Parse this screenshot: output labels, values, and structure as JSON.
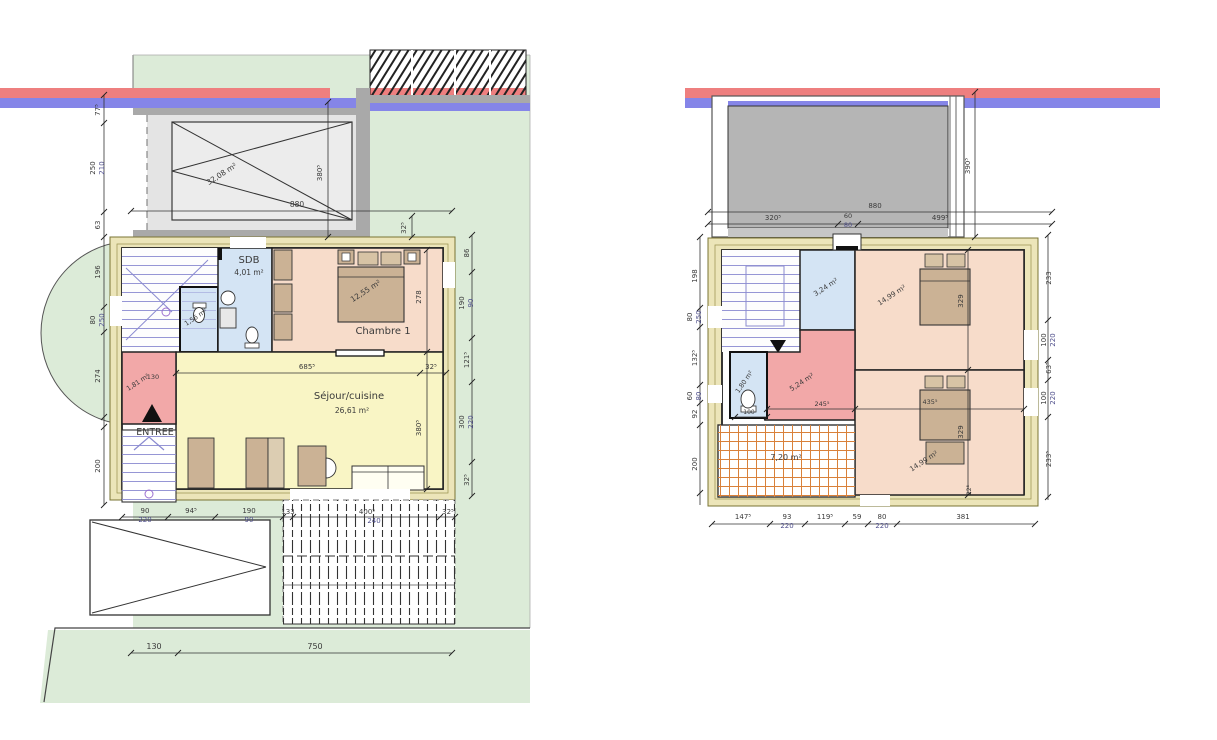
{
  "document": {
    "kind": "architectural floor plan, two levels side by side"
  },
  "colors": {
    "green": "#dcebd8",
    "red_stripe": "#ee7f7f",
    "blue_stripe": "#8585e8",
    "cream": "#ece5b9",
    "room_pink": "#f7dcca",
    "room_yellow": "#f9f5c5",
    "room_blue": "#d4e4f4",
    "room_red": "#f2a8a8",
    "roof_gray": "#b5b5b5",
    "drive_gray": "#e4e4e4",
    "wall_gray": "#a9a9a9",
    "furniture_tan": "#cbb295",
    "tile_orange": "#d9813a",
    "stair_blue": "#8a8ad0",
    "dim_color": "#3a3a3a",
    "dim_alt": "#50508c"
  },
  "ground_floor": {
    "rooms": [
      {
        "name": "SDB",
        "area": "4,01 m²"
      },
      {
        "name": "Chambre 1",
        "area": "12,55 m²"
      },
      {
        "name": "Séjour/cuisine",
        "area": "26,61 m²"
      },
      {
        "name": "WC",
        "area": "1,56 m²"
      },
      {
        "name": "Entrée",
        "area": "1,81 m²"
      }
    ],
    "entrance_label": "ENTREE",
    "carport_area": "32,08 m²"
  },
  "first_floor": {
    "rooms": [
      {
        "area": "3,24 m²"
      },
      {
        "area": "14,99 m²"
      },
      {
        "area": "5,24 m²"
      },
      {
        "area": "1,80 m²"
      },
      {
        "area": "7,20 m²"
      },
      {
        "area": "14,99 m²"
      }
    ]
  },
  "labels": [
    {
      "t": "SDB",
      "x": 249,
      "y": 263,
      "s": 10
    },
    {
      "t": "4,01 m²",
      "x": 249,
      "y": 275,
      "s": 7.5
    },
    {
      "t": "Chambre 1",
      "x": 383,
      "y": 334,
      "s": 10
    },
    {
      "t": "12,55 m²",
      "x": 367,
      "y": 293,
      "s": 7.5,
      "r": -33
    },
    {
      "t": "Séjour/cuisine",
      "x": 349,
      "y": 399,
      "s": 10
    },
    {
      "t": "26,61 m²",
      "x": 352,
      "y": 413,
      "s": 7.5
    },
    {
      "t": "ENTREE",
      "x": 155,
      "y": 435,
      "s": 9.5
    },
    {
      "t": "1,81 m²",
      "x": 139,
      "y": 384,
      "s": 6.5,
      "r": -33
    },
    {
      "t": "130",
      "x": 153,
      "y": 379,
      "s": 6.5
    },
    {
      "t": "1,56 m²",
      "x": 197,
      "y": 319,
      "s": 6.5,
      "r": -33
    },
    {
      "t": "32,08 m²",
      "x": 223,
      "y": 176,
      "s": 7.5,
      "r": -33
    },
    {
      "t": "880",
      "x": 297,
      "y": 207,
      "s": 7.5
    },
    {
      "t": "380⁵",
      "x": 322,
      "y": 173,
      "s": 7,
      "r": -90
    },
    {
      "t": "32⁵",
      "x": 406,
      "y": 228,
      "s": 7,
      "r": -90
    },
    {
      "t": "77⁵",
      "x": 100,
      "y": 110,
      "s": 7,
      "r": -90
    },
    {
      "t": "250",
      "x": 95,
      "y": 168,
      "s": 7,
      "r": -90
    },
    {
      "t": "210",
      "x": 104,
      "y": 168,
      "s": 7,
      "r": -90,
      "c": "#50508c"
    },
    {
      "t": "63",
      "x": 100,
      "y": 225,
      "s": 7,
      "r": -90
    },
    {
      "t": "196",
      "x": 100,
      "y": 272,
      "s": 7,
      "r": -90
    },
    {
      "t": "80",
      "x": 95,
      "y": 320,
      "s": 7,
      "r": -90
    },
    {
      "t": "250",
      "x": 104,
      "y": 320,
      "s": 7,
      "r": -90,
      "c": "#50508c"
    },
    {
      "t": "274",
      "x": 100,
      "y": 376,
      "s": 7,
      "r": -90
    },
    {
      "t": "200",
      "x": 100,
      "y": 466,
      "s": 7,
      "r": -90
    },
    {
      "t": "86",
      "x": 469,
      "y": 253,
      "s": 7,
      "r": -90
    },
    {
      "t": "190",
      "x": 464,
      "y": 303,
      "s": 7,
      "r": -90
    },
    {
      "t": "90",
      "x": 473,
      "y": 303,
      "s": 7,
      "r": -90,
      "c": "#50508c"
    },
    {
      "t": "121⁵",
      "x": 469,
      "y": 360,
      "s": 7,
      "r": -90
    },
    {
      "t": "300",
      "x": 464,
      "y": 422,
      "s": 7,
      "r": -90
    },
    {
      "t": "220",
      "x": 473,
      "y": 422,
      "s": 7,
      "r": -90,
      "c": "#50508c"
    },
    {
      "t": "32⁵",
      "x": 469,
      "y": 480,
      "s": 7,
      "r": -90
    },
    {
      "t": "685⁵",
      "x": 307,
      "y": 369,
      "s": 7
    },
    {
      "t": "32⁵",
      "x": 431,
      "y": 369,
      "s": 7
    },
    {
      "t": "278",
      "x": 421,
      "y": 297,
      "s": 7,
      "r": -90
    },
    {
      "t": "380⁵",
      "x": 421,
      "y": 428,
      "s": 7,
      "r": -90
    },
    {
      "t": "90",
      "x": 145,
      "y": 513,
      "s": 7
    },
    {
      "t": "220",
      "x": 145,
      "y": 522,
      "s": 7,
      "c": "#50508c"
    },
    {
      "t": "94⁵",
      "x": 191,
      "y": 513,
      "s": 7
    },
    {
      "t": "190",
      "x": 249,
      "y": 513,
      "s": 7
    },
    {
      "t": "90",
      "x": 249,
      "y": 522,
      "s": 7,
      "c": "#50508c"
    },
    {
      "t": "133",
      "x": 288,
      "y": 514,
      "s": 7
    },
    {
      "t": "400⁵",
      "x": 367,
      "y": 514,
      "s": 7
    },
    {
      "t": "240",
      "x": 374,
      "y": 523,
      "s": 7,
      "c": "#50508c"
    },
    {
      "t": "32⁵",
      "x": 448,
      "y": 514,
      "s": 7
    },
    {
      "t": "130",
      "x": 154,
      "y": 649,
      "s": 8
    },
    {
      "t": "750",
      "x": 315,
      "y": 649,
      "s": 8
    },
    {
      "t": "3,24 m²",
      "x": 827,
      "y": 289,
      "s": 7,
      "r": -33
    },
    {
      "t": "14,99 m²",
      "x": 893,
      "y": 297,
      "s": 7,
      "r": -33
    },
    {
      "t": "5,24 m²",
      "x": 803,
      "y": 384,
      "s": 7,
      "r": -33
    },
    {
      "t": "1,80 m²",
      "x": 746,
      "y": 383,
      "s": 6.5,
      "r": -55
    },
    {
      "t": "7,20 m²",
      "x": 786,
      "y": 460,
      "s": 8
    },
    {
      "t": "14,99 m²",
      "x": 925,
      "y": 463,
      "s": 7,
      "r": -33
    },
    {
      "t": "880",
      "x": 875,
      "y": 208,
      "s": 7
    },
    {
      "t": "320⁵",
      "x": 773,
      "y": 220,
      "s": 7
    },
    {
      "t": "60",
      "x": 848,
      "y": 218,
      "s": 6.5
    },
    {
      "t": "80",
      "x": 848,
      "y": 227,
      "s": 6.5,
      "c": "#50508c"
    },
    {
      "t": "499⁵",
      "x": 940,
      "y": 220,
      "s": 7
    },
    {
      "t": "390⁵",
      "x": 970,
      "y": 166,
      "s": 7,
      "r": -90
    },
    {
      "t": "198",
      "x": 697,
      "y": 276,
      "s": 7,
      "r": -90
    },
    {
      "t": "80",
      "x": 692,
      "y": 317,
      "s": 7,
      "r": -90
    },
    {
      "t": "250",
      "x": 701,
      "y": 317,
      "s": 7,
      "r": -90,
      "c": "#50508c"
    },
    {
      "t": "132⁵",
      "x": 697,
      "y": 358,
      "s": 7,
      "r": -90
    },
    {
      "t": "60",
      "x": 692,
      "y": 396,
      "s": 7,
      "r": -90
    },
    {
      "t": "80",
      "x": 701,
      "y": 396,
      "s": 7,
      "r": -90,
      "c": "#50508c"
    },
    {
      "t": "92",
      "x": 697,
      "y": 414,
      "s": 7,
      "r": -90
    },
    {
      "t": "200",
      "x": 697,
      "y": 464,
      "s": 7,
      "r": -90
    },
    {
      "t": "233",
      "x": 1051,
      "y": 278,
      "s": 7,
      "r": -90
    },
    {
      "t": "100",
      "x": 1046,
      "y": 340,
      "s": 7,
      "r": -90
    },
    {
      "t": "220",
      "x": 1055,
      "y": 340,
      "s": 7,
      "r": -90,
      "c": "#50508c"
    },
    {
      "t": "63⁵",
      "x": 1051,
      "y": 368,
      "s": 7,
      "r": -90
    },
    {
      "t": "100",
      "x": 1046,
      "y": 398,
      "s": 7,
      "r": -90
    },
    {
      "t": "220",
      "x": 1055,
      "y": 398,
      "s": 7,
      "r": -90,
      "c": "#50508c"
    },
    {
      "t": "233⁵",
      "x": 1051,
      "y": 459,
      "s": 7,
      "r": -90
    },
    {
      "t": "147⁵",
      "x": 743,
      "y": 519,
      "s": 7
    },
    {
      "t": "93",
      "x": 787,
      "y": 519,
      "s": 7
    },
    {
      "t": "220",
      "x": 787,
      "y": 528,
      "s": 7,
      "c": "#50508c"
    },
    {
      "t": "119⁵",
      "x": 825,
      "y": 519,
      "s": 7
    },
    {
      "t": "59",
      "x": 857,
      "y": 519,
      "s": 7
    },
    {
      "t": "80",
      "x": 882,
      "y": 519,
      "s": 7
    },
    {
      "t": "220",
      "x": 882,
      "y": 528,
      "s": 7,
      "c": "#50508c"
    },
    {
      "t": "381",
      "x": 963,
      "y": 519,
      "s": 7
    },
    {
      "t": "245⁵",
      "x": 822,
      "y": 406,
      "s": 6.5
    },
    {
      "t": "435⁵",
      "x": 930,
      "y": 404,
      "s": 6.5
    },
    {
      "t": "100",
      "x": 749,
      "y": 414,
      "s": 6
    },
    {
      "t": "329",
      "x": 963,
      "y": 301,
      "s": 7,
      "r": -90
    },
    {
      "t": "329",
      "x": 963,
      "y": 432,
      "s": 7,
      "r": -90
    },
    {
      "t": "22⁵",
      "x": 971,
      "y": 490,
      "s": 6,
      "r": -90
    }
  ]
}
